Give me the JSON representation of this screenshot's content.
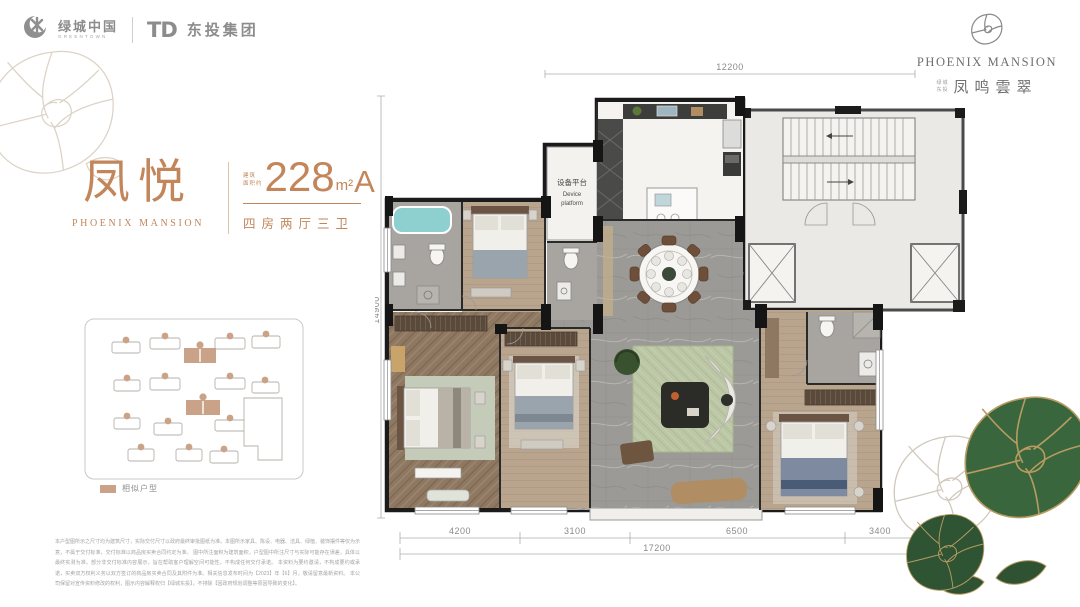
{
  "header": {
    "greentown": {
      "cn": "绿城中国",
      "en": "GREENTOWN"
    },
    "dongtou": {
      "mono": "TD",
      "cn": "东投集团"
    },
    "brand": {
      "en": "PHOENIX MANSION",
      "prefix_top": "绿城",
      "prefix_bottom": "东投",
      "cn": "凤鸣雲翠"
    }
  },
  "unit": {
    "name": "凤悦",
    "name_en": "PHOENIX MANSION",
    "area_prefix_line1": "建筑",
    "area_prefix_line2": "面积约",
    "area": "228",
    "area_unit": "m²",
    "unit_type": "A",
    "layout": "四房两厅三卫"
  },
  "siteplan": {
    "legend": "相似户型"
  },
  "floorplan": {
    "labels": {
      "device_platform_cn": "设备平台",
      "device_platform_en1": "Device",
      "device_platform_en2": "platform"
    },
    "dimensions": {
      "top": "12200",
      "left": "14900",
      "bottom_segments": [
        "4200",
        "3100",
        "6500",
        "3400"
      ],
      "bottom_total": "17200"
    }
  },
  "disclaimer": {
    "lines": [
      "本户型图所示之尺寸均为建筑尺寸，实际交付尺寸以政府最终审批图纸为准。本图所示家具、陈设、电器、洁具、绿植、装饰摆件等仅为示意，不属于交付标准，交付标准以商品房买卖合同约定为准。",
      "图中所注面积为建筑面积，户型图中所注尺寸与实际可能存在误差，具体以最终实测为准。部分非交付标准内容展示，旨在帮助客户理解空间可能性，不构成任何交付承诺。",
      "本资料为要约邀请，不构成要约或承诺，买卖双方权利义务以双方签订的商品房买卖合同及其附件为准。相关信息发布时间为【2023】年【6】月，敬请留意最新资料。",
      "本公司保留对宣传资料修改的权利，图示内容解释权归【绿城东投】，不排除【因政府规划调整等原因导致的变化】。"
    ]
  },
  "colors": {
    "accent": "#C2865A",
    "tan": "#C9A287",
    "wall": "#1B1B1B",
    "marble": "#9C9A96",
    "wood": "#B9A48E",
    "herringbone": "#8F7862",
    "rug": "#BCC7A6",
    "tub": "#8ECFCF",
    "core_floor": "#EAE9E5",
    "rose_green": "#39663C"
  }
}
